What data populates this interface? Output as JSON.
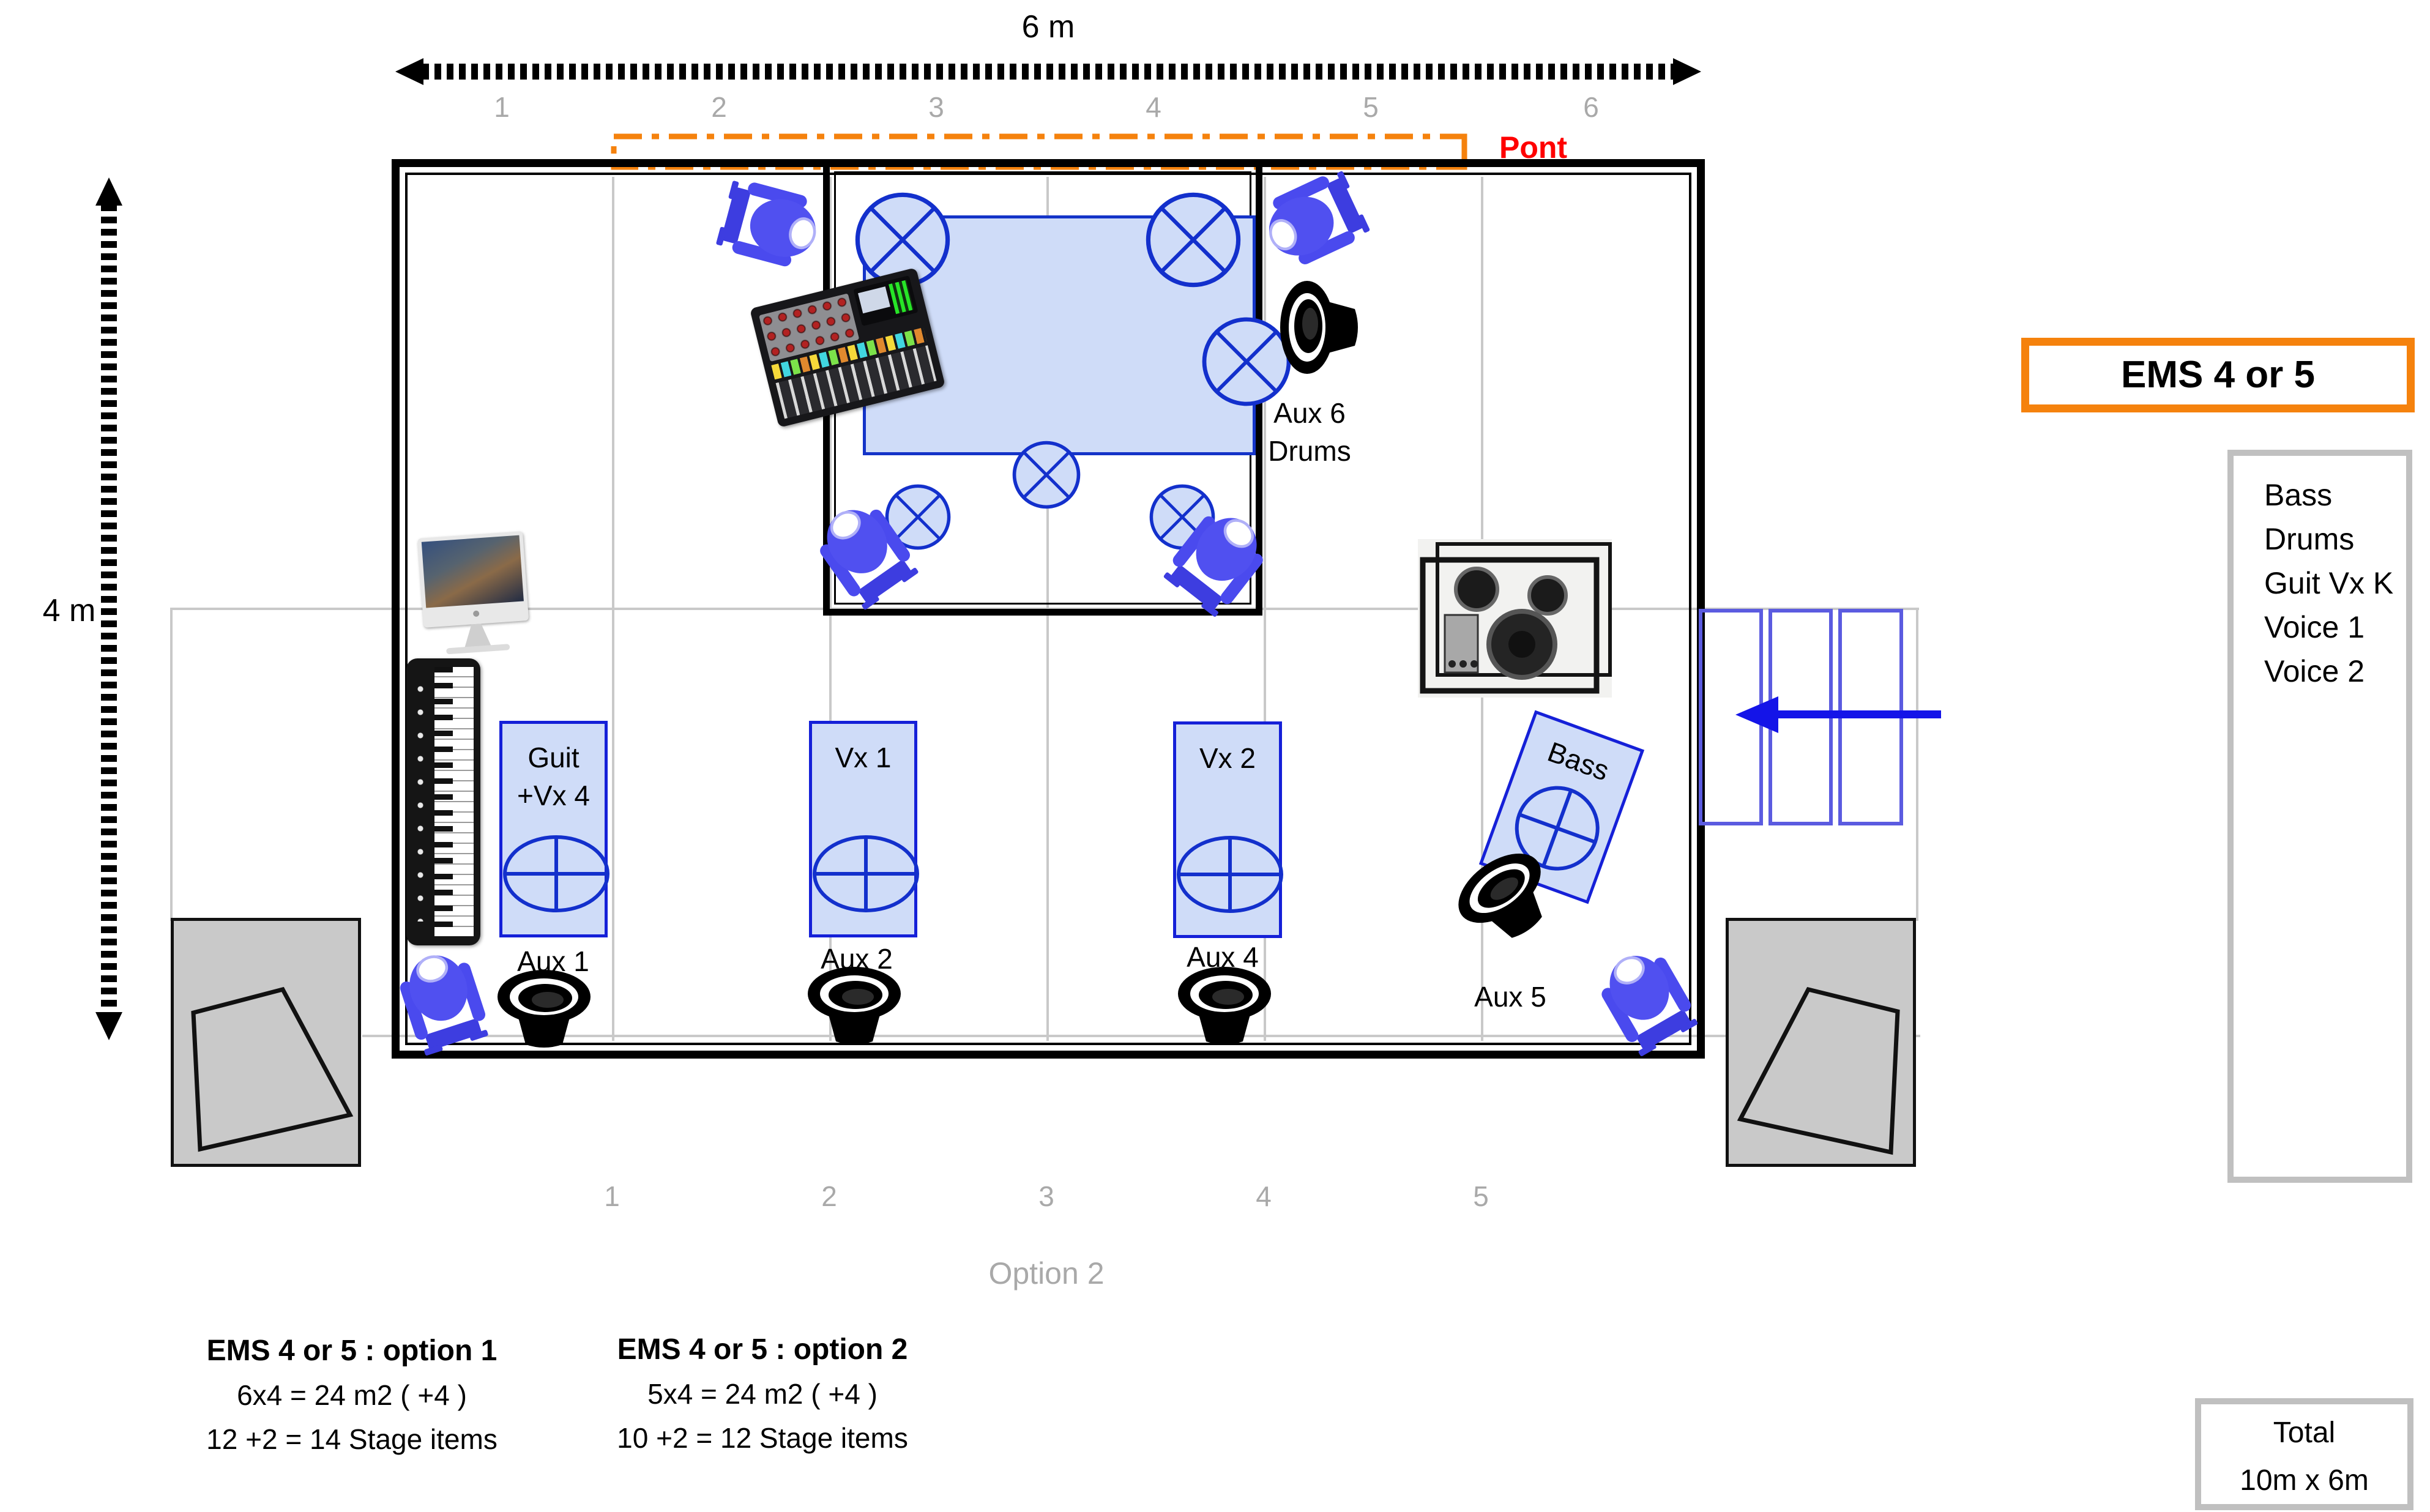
{
  "dimensions": {
    "width": "6 m",
    "height": "4 m"
  },
  "truss": {
    "label": "Pont"
  },
  "scale_top": {
    "numbers": [
      "1",
      "2",
      "3",
      "4",
      "5",
      "6"
    ]
  },
  "scale_bottom": {
    "numbers": [
      "1",
      "2",
      "3",
      "4",
      "5"
    ],
    "caption": "Option 2"
  },
  "stage": {
    "monitors": [
      {
        "line1": "Guit",
        "line2": "+Vx 4",
        "aux": "Aux 1"
      },
      {
        "line1": "Vx 1",
        "aux": "Aux 2"
      },
      {
        "line1": "Vx 2",
        "aux": "Aux 4"
      },
      {
        "line1": "Bass",
        "aux": "Aux 5"
      }
    ],
    "drum_monitor": {
      "aux": "Aux 6",
      "label": "Drums"
    }
  },
  "legend": {
    "ems_title": "EMS 4 or 5",
    "inputs": [
      "Bass",
      "Drums",
      "Guit Vx K",
      "Voice 1",
      "Voice 2"
    ],
    "total_label": "Total",
    "total_value": "10m x 6m"
  },
  "options": [
    {
      "title": "EMS 4 or 5 : option 1",
      "area": "6x4 = 24 m2 ( +4 )",
      "items": "12 +2 = 14 Stage items"
    },
    {
      "title": "EMS 4 or 5 : option 2",
      "area": "5x4 = 24 m2 ( +4 )",
      "items": "10 +2 = 12 Stage items"
    }
  ],
  "colors": {
    "accent_orange": "#f5820d",
    "label_red": "#ff0000",
    "blueprint_blue": "#1520d8",
    "fixture_blue": "#4a4aee",
    "muted_gray": "#a9a9a9"
  }
}
